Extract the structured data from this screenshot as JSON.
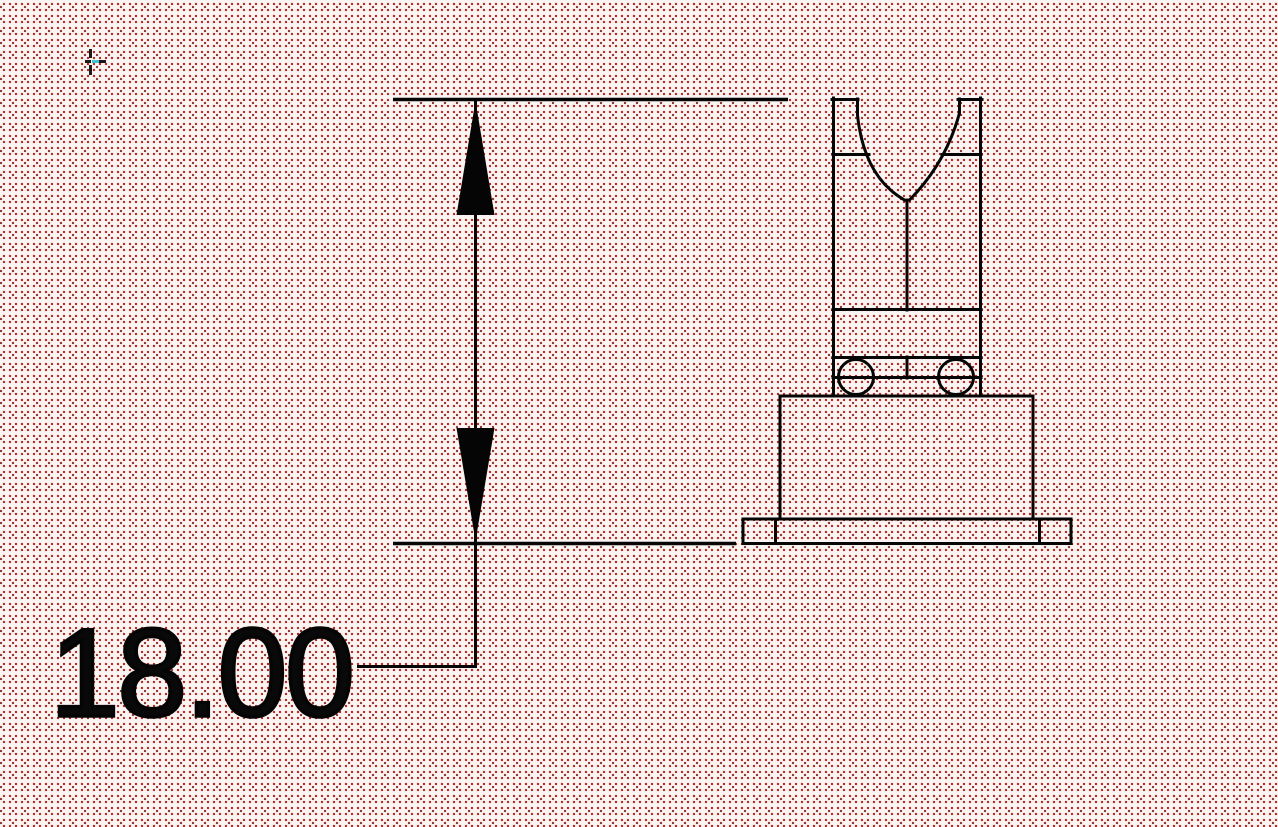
{
  "canvas": {
    "name": "cad-drawing-viewport",
    "dimension": {
      "value": "18.00"
    },
    "part": {
      "shape_name": "terminal-side-view"
    },
    "cursor": {
      "shape_name": "crosshair-cursor"
    }
  },
  "colors": {
    "line": "#000000",
    "canvas_background": "#faf4f3",
    "dot_primary": "#bb2a20",
    "dot_dark": "#8e3a31",
    "cursor_accent": "#3fc4d4"
  }
}
